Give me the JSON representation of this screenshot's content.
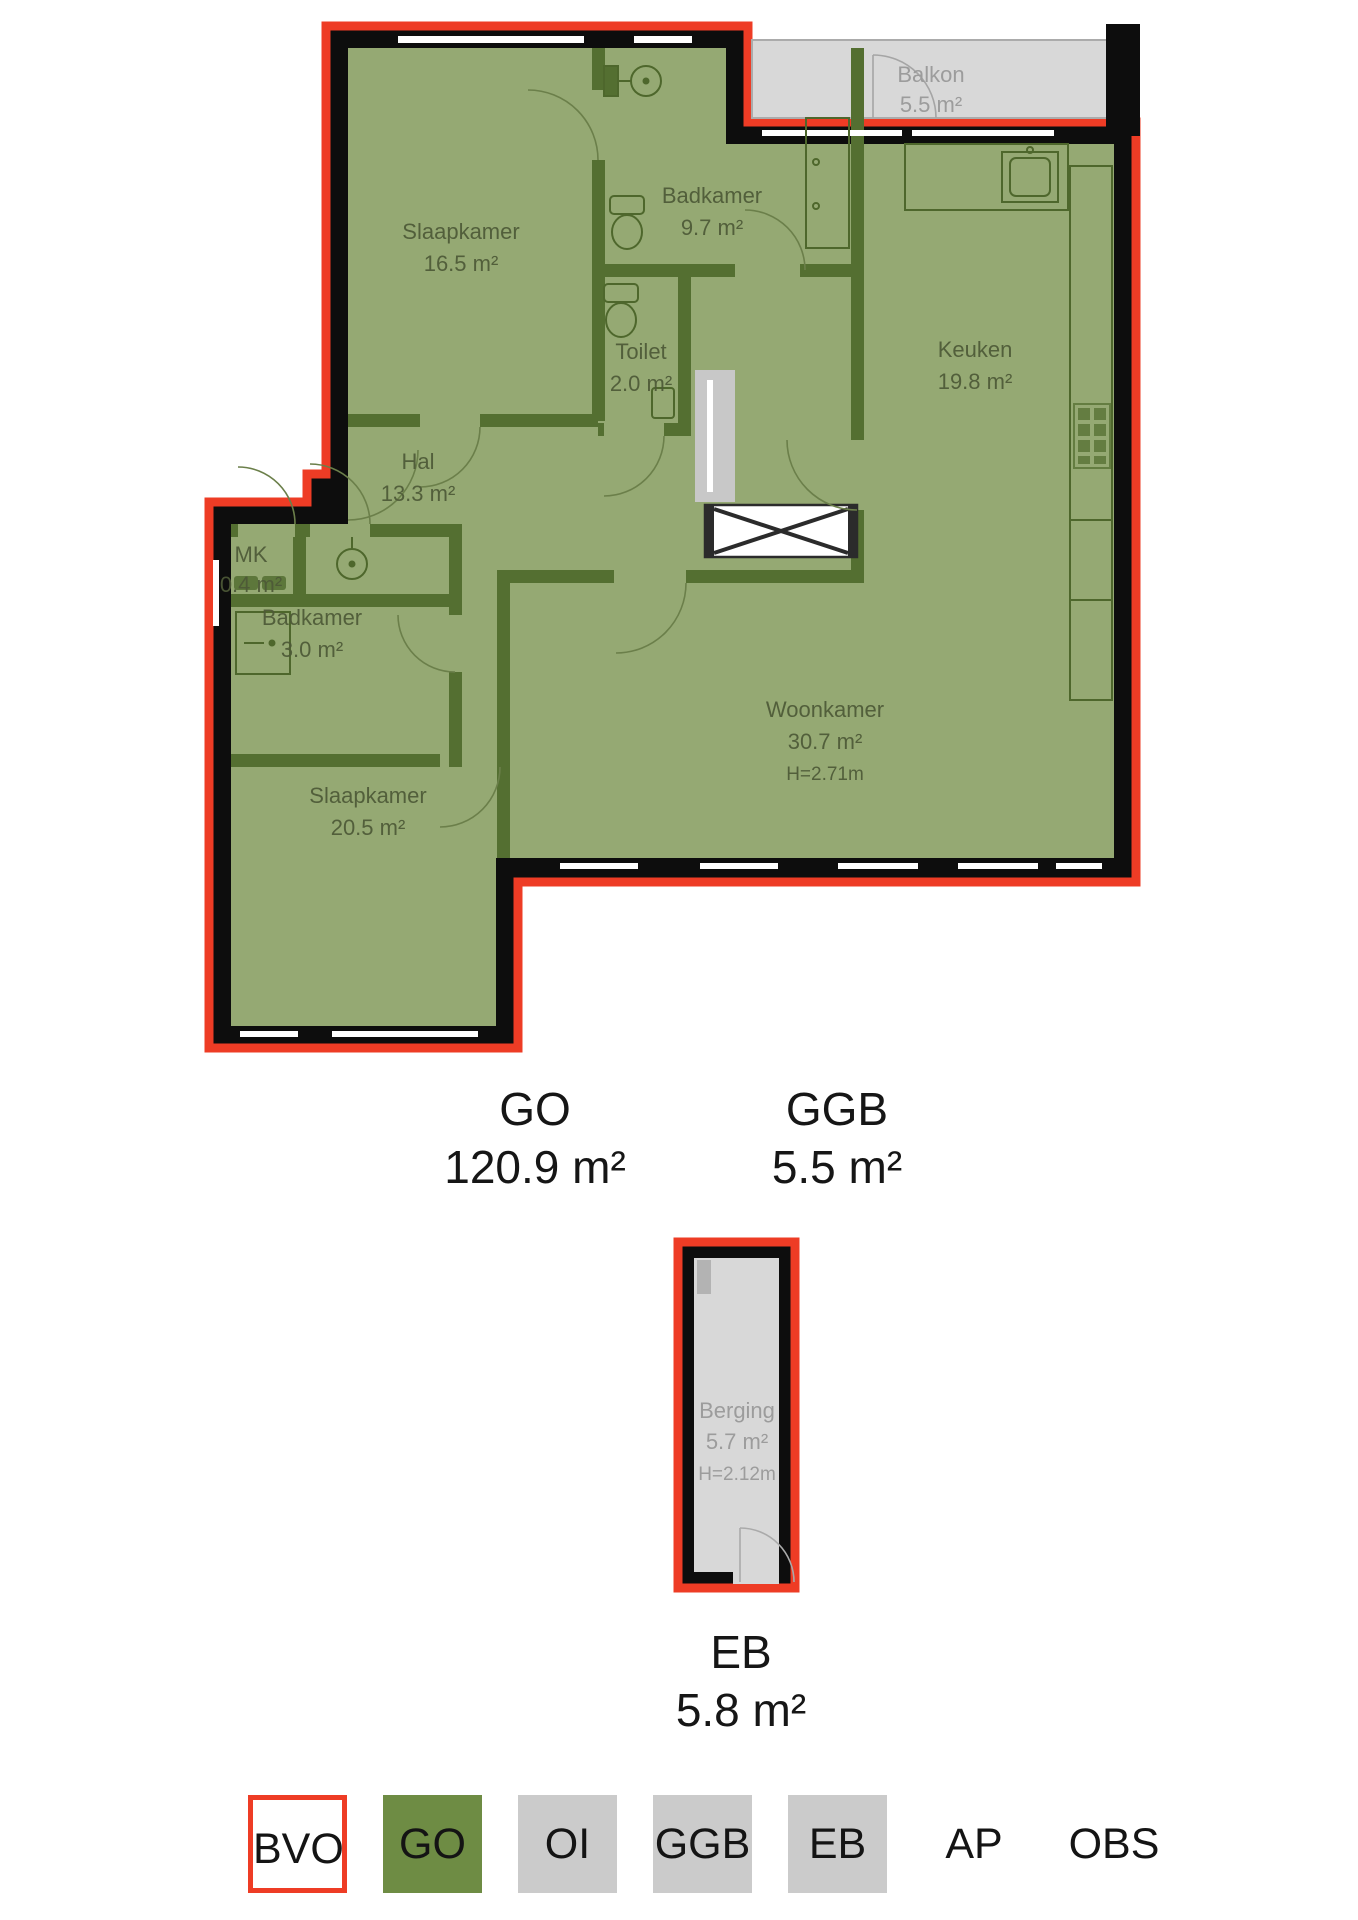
{
  "floor_plan": {
    "rooms": [
      {
        "id": "slaapkamer-1",
        "name": "Slaapkamer",
        "area": "16.5 m²"
      },
      {
        "id": "badkamer-1",
        "name": "Badkamer",
        "area": "9.7 m²"
      },
      {
        "id": "toilet",
        "name": "Toilet",
        "area": "2.0 m²"
      },
      {
        "id": "keuken",
        "name": "Keuken",
        "area": "19.8 m²"
      },
      {
        "id": "balkon",
        "name": "Balkon",
        "area": "5.5 m²"
      },
      {
        "id": "hal",
        "name": "Hal",
        "area": "13.3 m²"
      },
      {
        "id": "meterkast",
        "name": "MK",
        "area": "0.4 m²"
      },
      {
        "id": "badkamer-2",
        "name": "Badkamer",
        "area": "3.0 m²"
      },
      {
        "id": "woonkamer",
        "name": "Woonkamer",
        "area": "30.7 m²",
        "height": "H=2.71m"
      },
      {
        "id": "slaapkamer-2",
        "name": "Slaapkamer",
        "area": "20.5 m²"
      }
    ],
    "storage": {
      "name": "Berging",
      "area": "5.7 m²",
      "height": "H=2.12m"
    }
  },
  "summary": {
    "go": {
      "label": "GO",
      "value": "120.9 m²"
    },
    "ggb": {
      "label": "GGB",
      "value": "5.5 m²"
    },
    "eb": {
      "label": "EB",
      "value": "5.8 m²"
    }
  },
  "legend": {
    "items": [
      {
        "label": "BVO",
        "style": "red-outline"
      },
      {
        "label": "GO",
        "style": "green"
      },
      {
        "label": "OI",
        "style": "gray"
      },
      {
        "label": "GGB",
        "style": "gray"
      },
      {
        "label": "EB",
        "style": "gray"
      },
      {
        "label": "AP",
        "style": "plain"
      },
      {
        "label": "OBS",
        "style": "plain"
      }
    ]
  },
  "colors": {
    "bvo_red": "#ee3c25",
    "go_green": "#6e8c44",
    "room_green": "#95a973",
    "wall_green": "#546f31",
    "wall_black": "#0d0d0d",
    "surface_gray": "#d8d8d8",
    "legend_gray": "#cbcbcb"
  }
}
